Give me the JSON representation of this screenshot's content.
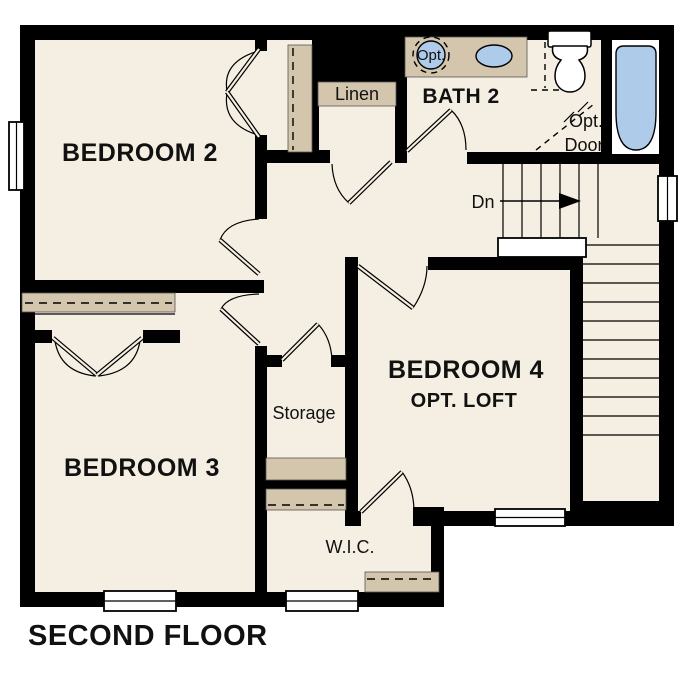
{
  "title": "SECOND FLOOR",
  "colors": {
    "wall": "#000000",
    "floor": "#f5eee2",
    "closet": "#d3c6ad",
    "fixture": "#aecbea",
    "white": "#ffffff"
  },
  "rooms": {
    "bedroom2": {
      "label": "BEDROOM 2"
    },
    "bedroom3": {
      "label": "BEDROOM 3"
    },
    "bedroom4": {
      "label": "BEDROOM 4",
      "sublabel": "OPT. LOFT"
    },
    "bath2": {
      "label": "BATH 2"
    },
    "linen": {
      "label": "Linen"
    },
    "storage": {
      "label": "Storage"
    },
    "wic": {
      "label": "W.I.C."
    }
  },
  "annotations": {
    "stairs_down": "Dn",
    "optional_sink": "Opt.",
    "optional_door_line1": "Opt.",
    "optional_door_line2": "Door"
  }
}
